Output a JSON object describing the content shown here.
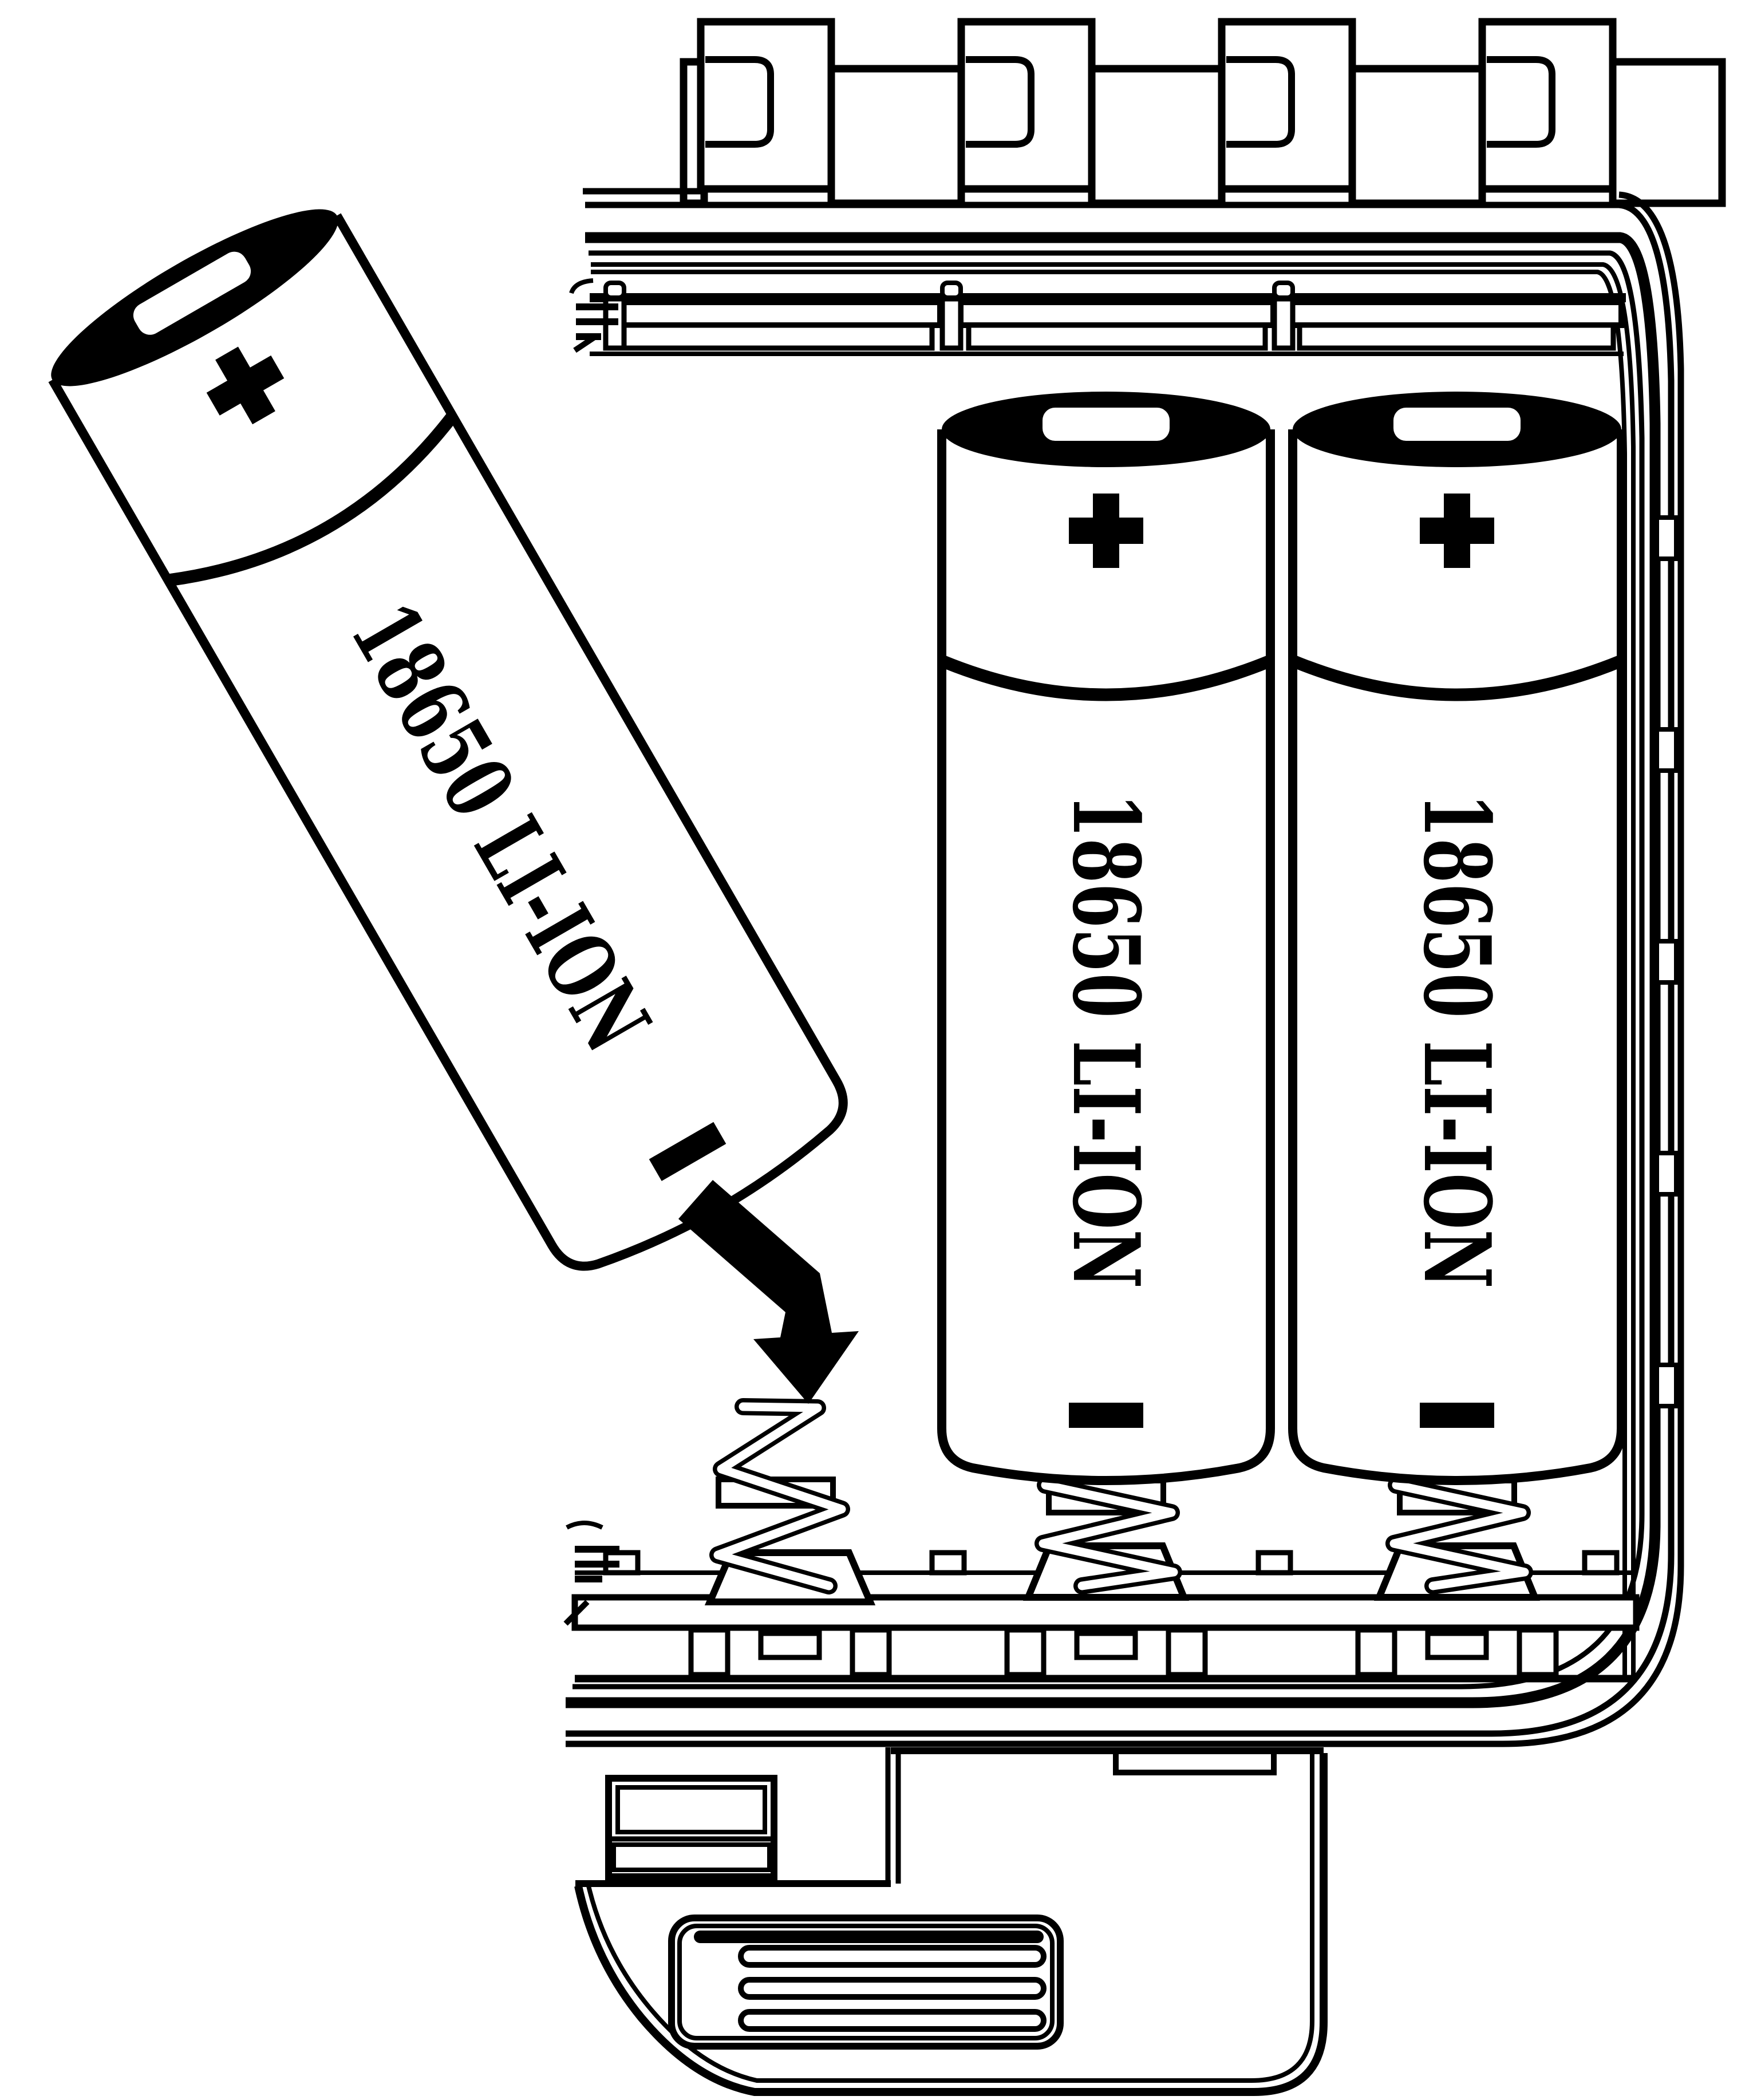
{
  "figure": {
    "title": "18650 Li-Ion battery installation illustration",
    "style": "black and white instructional line art"
  },
  "colors": {
    "ink": "#000000",
    "paper": "#ffffff"
  },
  "batteries": [
    {
      "id": "inserting-battery",
      "label": "18650 LI-ION",
      "positive_symbol": "+",
      "negative_symbol": "-"
    },
    {
      "id": "installed-battery-left",
      "label": "18650 LI-ION",
      "positive_symbol": "+",
      "negative_symbol": "-"
    },
    {
      "id": "installed-battery-right",
      "label": "18650 LI-ION",
      "positive_symbol": "+",
      "negative_symbol": "-"
    }
  ],
  "compartment": {
    "slots": 3,
    "empty_slots": 1,
    "springs": 3,
    "hinge_teeth": 4,
    "wall_clips": 5
  }
}
